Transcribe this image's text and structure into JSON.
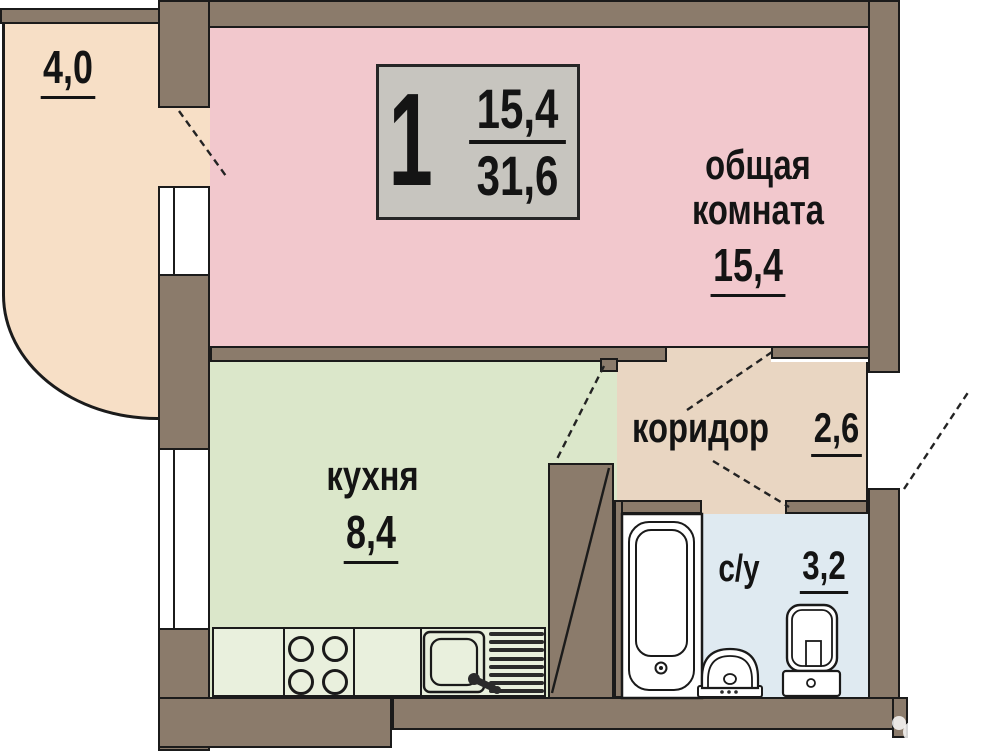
{
  "plan_label": {
    "rooms_count": "1",
    "living_area": "15,4",
    "total_area": "31,6"
  },
  "rooms": {
    "living": {
      "name": "общая комната",
      "area": "15,4"
    },
    "kitchen": {
      "name": "кухня",
      "area": "8,4"
    },
    "corridor": {
      "name": "коридор",
      "area": "2,6"
    },
    "bathroom": {
      "name": "с/у",
      "area": "3,2"
    },
    "balcony": {
      "area": "4,0"
    }
  },
  "watermark": {
    "brand": "Avito"
  },
  "colors": {
    "wall": "#8b7b6b",
    "outline": "#1b1b1b",
    "living_room_fill": "#f2c8cd",
    "kitchen_fill": "#dbe7ca",
    "counter_fill": "#e9f0dd",
    "corridor_fill": "#e9d6c2",
    "bathroom_fill": "#dfeaf1",
    "balcony_fill": "#f7dfc6",
    "label_box_bg": "#c7c5bf"
  }
}
